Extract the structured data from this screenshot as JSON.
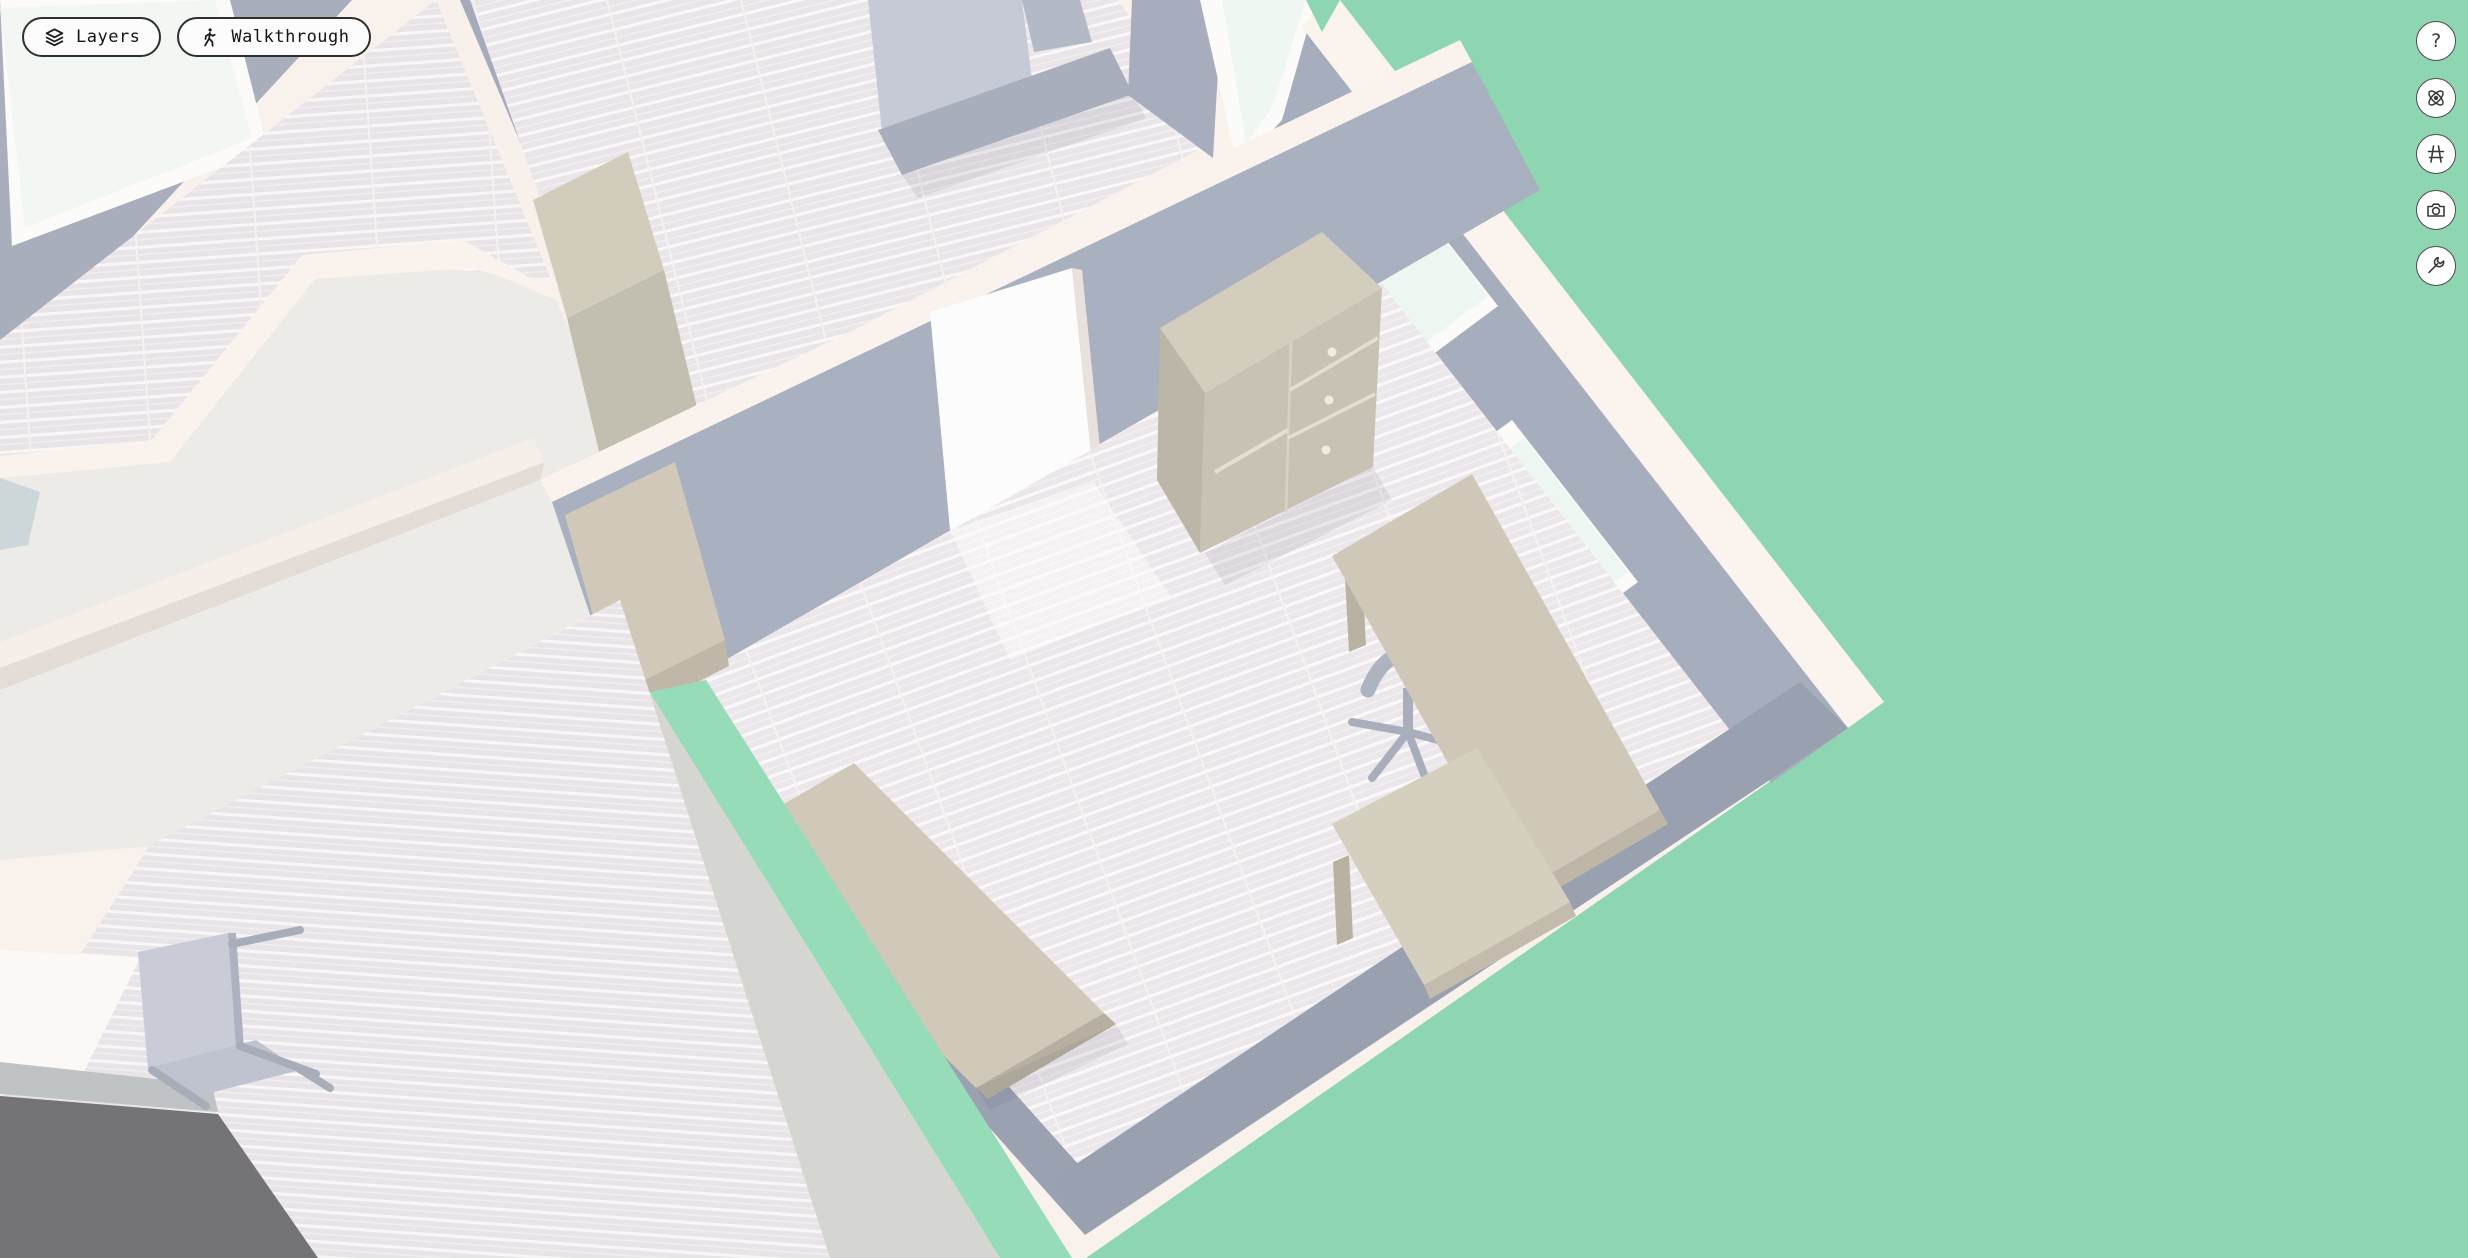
{
  "app": {
    "description": "3D floor plan viewer with isometric dollhouse view of an office/apartment interior on a mint green ground"
  },
  "toolbar": {
    "layers": {
      "label": "Layers",
      "icon": "layers-icon"
    },
    "walkthrough": {
      "label": "Walkthrough",
      "icon": "walkthrough-icon"
    }
  },
  "side_controls": {
    "help_label": "?",
    "buttons": [
      {
        "name": "help",
        "icon": "question-mark-icon"
      },
      {
        "name": "orbit-view",
        "icon": "orbit-icon"
      },
      {
        "name": "perspective-grid",
        "icon": "grid-icon"
      },
      {
        "name": "snapshot",
        "icon": "camera-icon"
      },
      {
        "name": "tools",
        "icon": "wrench-icon"
      }
    ]
  },
  "colors": {
    "ground_green": "#8ed5b2",
    "lawn_strip_green": "#96dcb9",
    "wall_cap_cream": "#f9f1ec",
    "wall_face_blue_gray": "#a9afbe",
    "wall_face_shaded": "#9aa1b1",
    "floor_wood_light": "#eae5e8",
    "roof_plane": "#edebe7",
    "concrete_walkway": "#d5d6d1",
    "furniture_beige_top": "#d2ccbc",
    "furniture_beige_front": "#c8c2b3",
    "sofa_blue_gray": "#a9aebd",
    "glass_mint": "#eef6f1",
    "dark_floor_patch": "#737378",
    "button_bg": "#fcfcfc",
    "button_border": "#2f2f2f"
  },
  "scene": {
    "view": "isometric-top-down, building rotated diagonally",
    "objects": [
      {
        "name": "mint-green-ground"
      },
      {
        "name": "apartment-block-with-cream-wall-caps"
      },
      {
        "name": "office-room-wood-floor"
      },
      {
        "name": "interior-white-door"
      },
      {
        "name": "chest-of-drawers"
      },
      {
        "name": "corner-window-upper"
      },
      {
        "name": "corner-window-lower"
      },
      {
        "name": "l-shaped-desk"
      },
      {
        "name": "office-swivel-chair"
      },
      {
        "name": "low-sideboard"
      },
      {
        "name": "storage-cabinet-office"
      },
      {
        "name": "lounge-room-wood-floor"
      },
      {
        "name": "lounge-sofa"
      },
      {
        "name": "tall-two-tone-cabinet"
      },
      {
        "name": "skylight-pane-top-left"
      },
      {
        "name": "skylight-pane-top-right"
      },
      {
        "name": "roof-terrace-planes"
      },
      {
        "name": "concrete-walkway"
      },
      {
        "name": "lawn-strip-between-walls"
      },
      {
        "name": "bottom-left-room-wood-floor"
      },
      {
        "name": "tipped-gray-chair"
      },
      {
        "name": "dark-gray-floor-patch"
      }
    ]
  }
}
